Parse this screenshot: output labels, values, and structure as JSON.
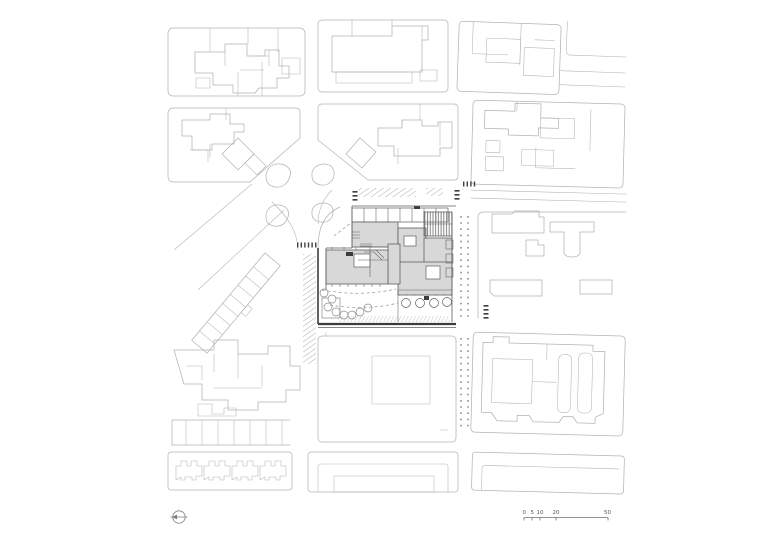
{
  "page": {
    "background": "#ffffff"
  },
  "theme": {
    "line": "#b3b3b3",
    "site_line": "#5f5f5f",
    "roof_fill": "#d8d8d8",
    "hatch": "#9b9b9b",
    "crosswalk": "#3f3f3f",
    "boundary": "#3c3c3c",
    "text": "#555555"
  },
  "legend": {
    "north_arrow_icon": "north-arrow",
    "scale_bar": {
      "labels": [
        "0",
        "5",
        "10",
        "20",
        "50"
      ]
    }
  }
}
